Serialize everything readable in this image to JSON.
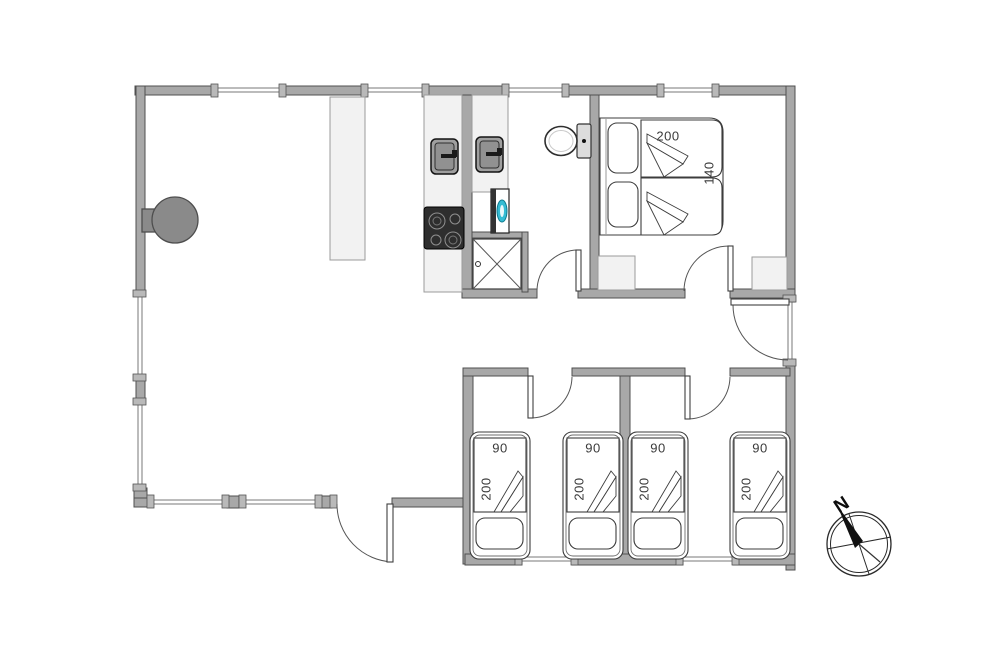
{
  "plan": {
    "master_bedroom": {
      "bed_length_cm": "200",
      "bed_width_cm": "140"
    },
    "single_rooms": [
      {
        "bed_width_cm": "90",
        "bed_length_cm": "200"
      },
      {
        "bed_width_cm": "90",
        "bed_length_cm": "200"
      },
      {
        "bed_width_cm": "90",
        "bed_length_cm": "200"
      },
      {
        "bed_width_cm": "90",
        "bed_length_cm": "200"
      }
    ],
    "compass_north": "N"
  },
  "colors": {
    "wall": "#a8a8a8",
    "furniture_light": "#f2f2f2",
    "teal_accent": "#35bcd4",
    "text": "#3a3a3a"
  }
}
